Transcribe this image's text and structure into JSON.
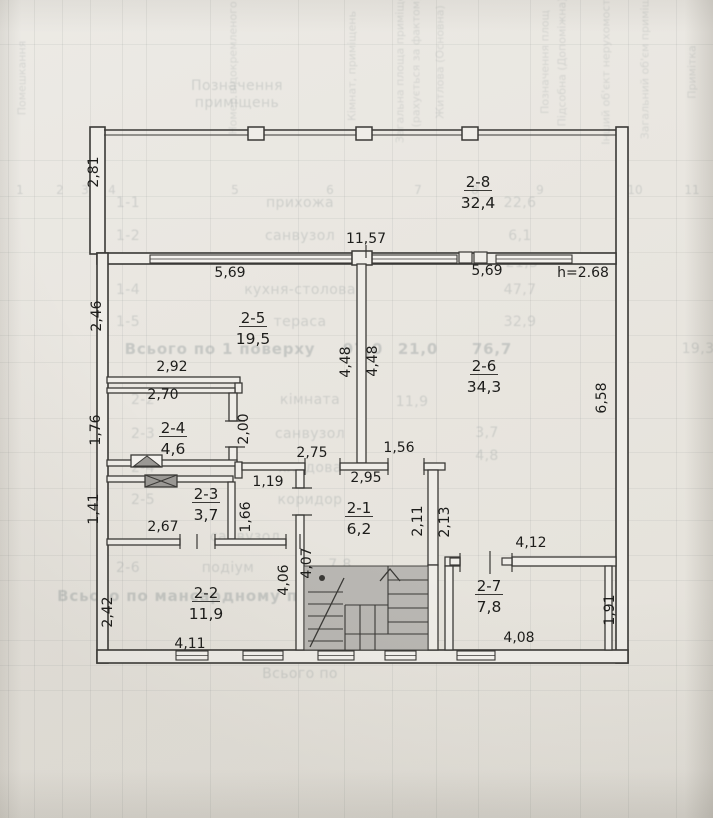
{
  "plan": {
    "height_note": "h=2.68",
    "rooms": [
      {
        "id": "2-8",
        "area": "32,4",
        "x": 478,
        "y": 187
      },
      {
        "id": "2-5",
        "area": "19,5",
        "x": 253,
        "y": 323
      },
      {
        "id": "2-6",
        "area": "34,3",
        "x": 484,
        "y": 371
      },
      {
        "id": "2-4",
        "area": "4,6",
        "x": 173,
        "y": 433
      },
      {
        "id": "2-3",
        "area": "3,7",
        "x": 206,
        "y": 499
      },
      {
        "id": "2-1",
        "area": "6,2",
        "x": 359,
        "y": 513
      },
      {
        "id": "2-2",
        "area": "11,9",
        "x": 206,
        "y": 598
      },
      {
        "id": "2-7",
        "area": "7,8",
        "x": 489,
        "y": 591
      }
    ],
    "dimensions": [
      {
        "t": "2,81",
        "x": 98,
        "y": 172,
        "r": 1
      },
      {
        "t": "11,57",
        "x": 366,
        "y": 243
      },
      {
        "t": "5,69",
        "x": 230,
        "y": 277
      },
      {
        "t": "5,69",
        "x": 487,
        "y": 275
      },
      {
        "t": "h=2.68",
        "x": 583,
        "y": 277
      },
      {
        "t": "2,46",
        "x": 101,
        "y": 316,
        "r": 1
      },
      {
        "t": "2,92",
        "x": 172,
        "y": 371
      },
      {
        "t": "2,70",
        "x": 163,
        "y": 399
      },
      {
        "t": "1,76",
        "x": 100,
        "y": 430,
        "r": 1
      },
      {
        "t": "2,00",
        "x": 248,
        "y": 429,
        "r": 1
      },
      {
        "t": "4,48",
        "x": 350,
        "y": 362,
        "r": 1
      },
      {
        "t": "4,48",
        "x": 377,
        "y": 361,
        "r": 1
      },
      {
        "t": "6,58",
        "x": 606,
        "y": 398,
        "r": 1
      },
      {
        "t": "1,41",
        "x": 98,
        "y": 509,
        "r": 1
      },
      {
        "t": "2,67",
        "x": 163,
        "y": 531
      },
      {
        "t": "1,19",
        "x": 268,
        "y": 486
      },
      {
        "t": "1,66",
        "x": 250,
        "y": 517,
        "r": 1
      },
      {
        "t": "2,75",
        "x": 312,
        "y": 457
      },
      {
        "t": "1,56",
        "x": 399,
        "y": 452
      },
      {
        "t": "2,95",
        "x": 366,
        "y": 482
      },
      {
        "t": "2,11",
        "x": 422,
        "y": 521,
        "r": 1
      },
      {
        "t": "2,13",
        "x": 449,
        "y": 522,
        "r": 1
      },
      {
        "t": "4,07",
        "x": 311,
        "y": 563,
        "r": 1
      },
      {
        "t": "4,06",
        "x": 288,
        "y": 580,
        "r": 1
      },
      {
        "t": "2,42",
        "x": 112,
        "y": 612,
        "r": 1
      },
      {
        "t": "4,11",
        "x": 190,
        "y": 648
      },
      {
        "t": "4,12",
        "x": 531,
        "y": 547
      },
      {
        "t": "1,91",
        "x": 614,
        "y": 610,
        "r": 1
      },
      {
        "t": "4,08",
        "x": 519,
        "y": 642
      }
    ]
  },
  "bleed_table": {
    "column_headers": [
      {
        "t": "Помешкання",
        "x": 22,
        "y": 78
      },
      {
        "t": "Номер відокремленого",
        "x": 233,
        "y": 68
      },
      {
        "t": "Кімнат, приміщень",
        "x": 352,
        "y": 66
      },
      {
        "t": "Загальна площа приміщень",
        "x": 400,
        "y": 62
      },
      {
        "t": "(рахується за фактом)",
        "x": 416,
        "y": 62
      },
      {
        "t": "Житлова (Основна)",
        "x": 440,
        "y": 62
      },
      {
        "t": "Позначення площ",
        "x": 545,
        "y": 62
      },
      {
        "t": "Підсобна (Допоміжна)",
        "x": 562,
        "y": 62
      },
      {
        "t": "Інший об'єкт нерухомості (м²)",
        "x": 606,
        "y": 58
      },
      {
        "t": "Загальний об'єм приміщень",
        "x": 645,
        "y": 58
      },
      {
        "t": "Примітка",
        "x": 692,
        "y": 72
      }
    ],
    "column_numbers": [
      {
        "t": "1",
        "x": 20
      },
      {
        "t": "2",
        "x": 60
      },
      {
        "t": "3",
        "x": 85
      },
      {
        "t": "4",
        "x": 112
      },
      {
        "t": "5",
        "x": 235
      },
      {
        "t": "6",
        "x": 330
      },
      {
        "t": "7",
        "x": 418
      },
      {
        "t": "8",
        "x": 475
      },
      {
        "t": "9",
        "x": 540
      },
      {
        "t": "10",
        "x": 635
      },
      {
        "t": "11",
        "x": 692
      }
    ],
    "rows": [
      {
        "t": "Позначення",
        "x": 237,
        "y": 86
      },
      {
        "t": "приміщень",
        "x": 237,
        "y": 103
      },
      {
        "t": "1-1",
        "x": 128,
        "y": 203
      },
      {
        "t": "прихожа",
        "x": 300,
        "y": 203
      },
      {
        "t": "22,6",
        "x": 520,
        "y": 203
      },
      {
        "t": "1-2",
        "x": 128,
        "y": 236
      },
      {
        "t": "санвузол",
        "x": 300,
        "y": 236
      },
      {
        "t": "6,1",
        "x": 520,
        "y": 236
      },
      {
        "t": "21,3",
        "x": 522,
        "y": 263
      },
      {
        "t": "1-4",
        "x": 128,
        "y": 290
      },
      {
        "t": "кухня-столова",
        "x": 300,
        "y": 290
      },
      {
        "t": "47,7",
        "x": 520,
        "y": 290
      },
      {
        "t": "1-5",
        "x": 128,
        "y": 322
      },
      {
        "t": "тераса",
        "x": 300,
        "y": 322
      },
      {
        "t": "32,9",
        "x": 520,
        "y": 322
      },
      {
        "t": "Всього по 1 поверху",
        "x": 220,
        "y": 349,
        "s": 1
      },
      {
        "t": "97,0",
        "x": 363,
        "y": 349,
        "s": 1
      },
      {
        "t": "21,0",
        "x": 418,
        "y": 349,
        "s": 1
      },
      {
        "t": "76,7",
        "x": 492,
        "y": 349,
        "s": 1
      },
      {
        "t": "19,3",
        "x": 698,
        "y": 349
      },
      {
        "t": "2-2",
        "x": 143,
        "y": 400
      },
      {
        "t": "кімната",
        "x": 310,
        "y": 400
      },
      {
        "t": "11,9",
        "x": 412,
        "y": 402
      },
      {
        "t": "2-3",
        "x": 143,
        "y": 434
      },
      {
        "t": "санвузол",
        "x": 310,
        "y": 434
      },
      {
        "t": "3,7",
        "x": 487,
        "y": 433
      },
      {
        "t": "2-4",
        "x": 143,
        "y": 468
      },
      {
        "t": "кладова",
        "x": 310,
        "y": 468
      },
      {
        "t": "4,8",
        "x": 487,
        "y": 456
      },
      {
        "t": "2-5",
        "x": 143,
        "y": 500
      },
      {
        "t": "коридор",
        "x": 310,
        "y": 500
      },
      {
        "t": "санвузол",
        "x": 245,
        "y": 537
      },
      {
        "t": "2-6",
        "x": 128,
        "y": 568
      },
      {
        "t": "подіум",
        "x": 228,
        "y": 568
      },
      {
        "t": "7,8",
        "x": 340,
        "y": 565
      },
      {
        "t": "Всього по мансардному поверху",
        "x": 210,
        "y": 596,
        "s": 1
      },
      {
        "t": "Всього по",
        "x": 300,
        "y": 674
      }
    ]
  },
  "colors": {
    "paper": "#e9e6e0",
    "wall": "#3a3936",
    "wall_fill": "#efede8",
    "dim_text": "#1d1d1b",
    "stair_fill": "#b9b7b3",
    "bleed_text": "#8d9697"
  }
}
